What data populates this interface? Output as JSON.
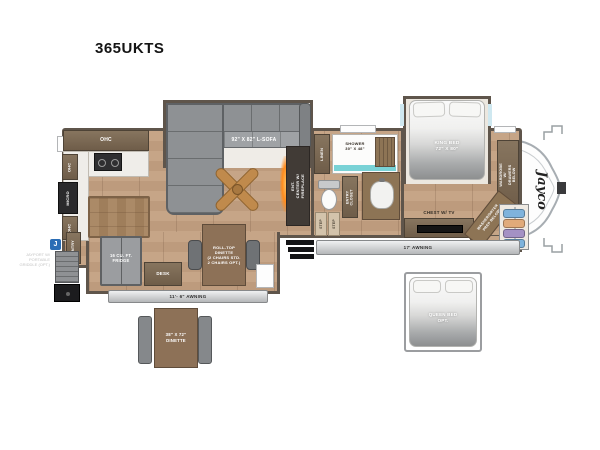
{
  "title": "365UKTS",
  "brand": {
    "logo": "Jayco",
    "badge": "J"
  },
  "living": {
    "sofa_label": "92\" X 82\" L-SOFA",
    "ent_center_label": "ENT. CENTER W/\nFIREPLACE",
    "entry_closet_label": "ENTRY\nCLOSET"
  },
  "kitchen": {
    "ohc_label": "OHC",
    "micro_label": "MICRO",
    "pantry_label": "PANTRY",
    "fridge_label": "16 CU. FT.\nFRIDGE",
    "desk_label": "DESK"
  },
  "bath": {
    "linen_label": "LINEN",
    "shower_label": "SHOWER\n30\" X 48\"",
    "step_label": "STEP"
  },
  "bedroom": {
    "king_bed_label": "KING BED\n72\" X 80\"",
    "chest_label": "CHEST W/ TV",
    "wardrobe_label": "WARDROBE W/\nDRAWERS BELOW",
    "washer_label": "WASHER/DRYER\nPREP BELOW"
  },
  "dinette": {
    "rolltop_label": "ROLL-TOP\nDINETTE\n(2 CHAIRS STD.\n2 CHAIRS OPT.)",
    "freestanding_label": "38\" X 72\"\nDINETTE"
  },
  "awnings": {
    "main": "17' AWNING",
    "secondary": "11'- 6\" AWNING"
  },
  "options": {
    "alt_bed_label": "QUEEN BED\nOPT."
  },
  "exterior": {
    "jayport_note": "JAYPORT W/\nPORTABLE\nGRIDDLE (OPT.)"
  },
  "colors": {
    "wood": "#c2a183",
    "wall": "#5f554b",
    "sofa_gray": "#8e9194",
    "teal_shower": "#79d2d6",
    "fireplace_orange": "#ff9a2e",
    "jayco_blue": "#2a6db5"
  }
}
